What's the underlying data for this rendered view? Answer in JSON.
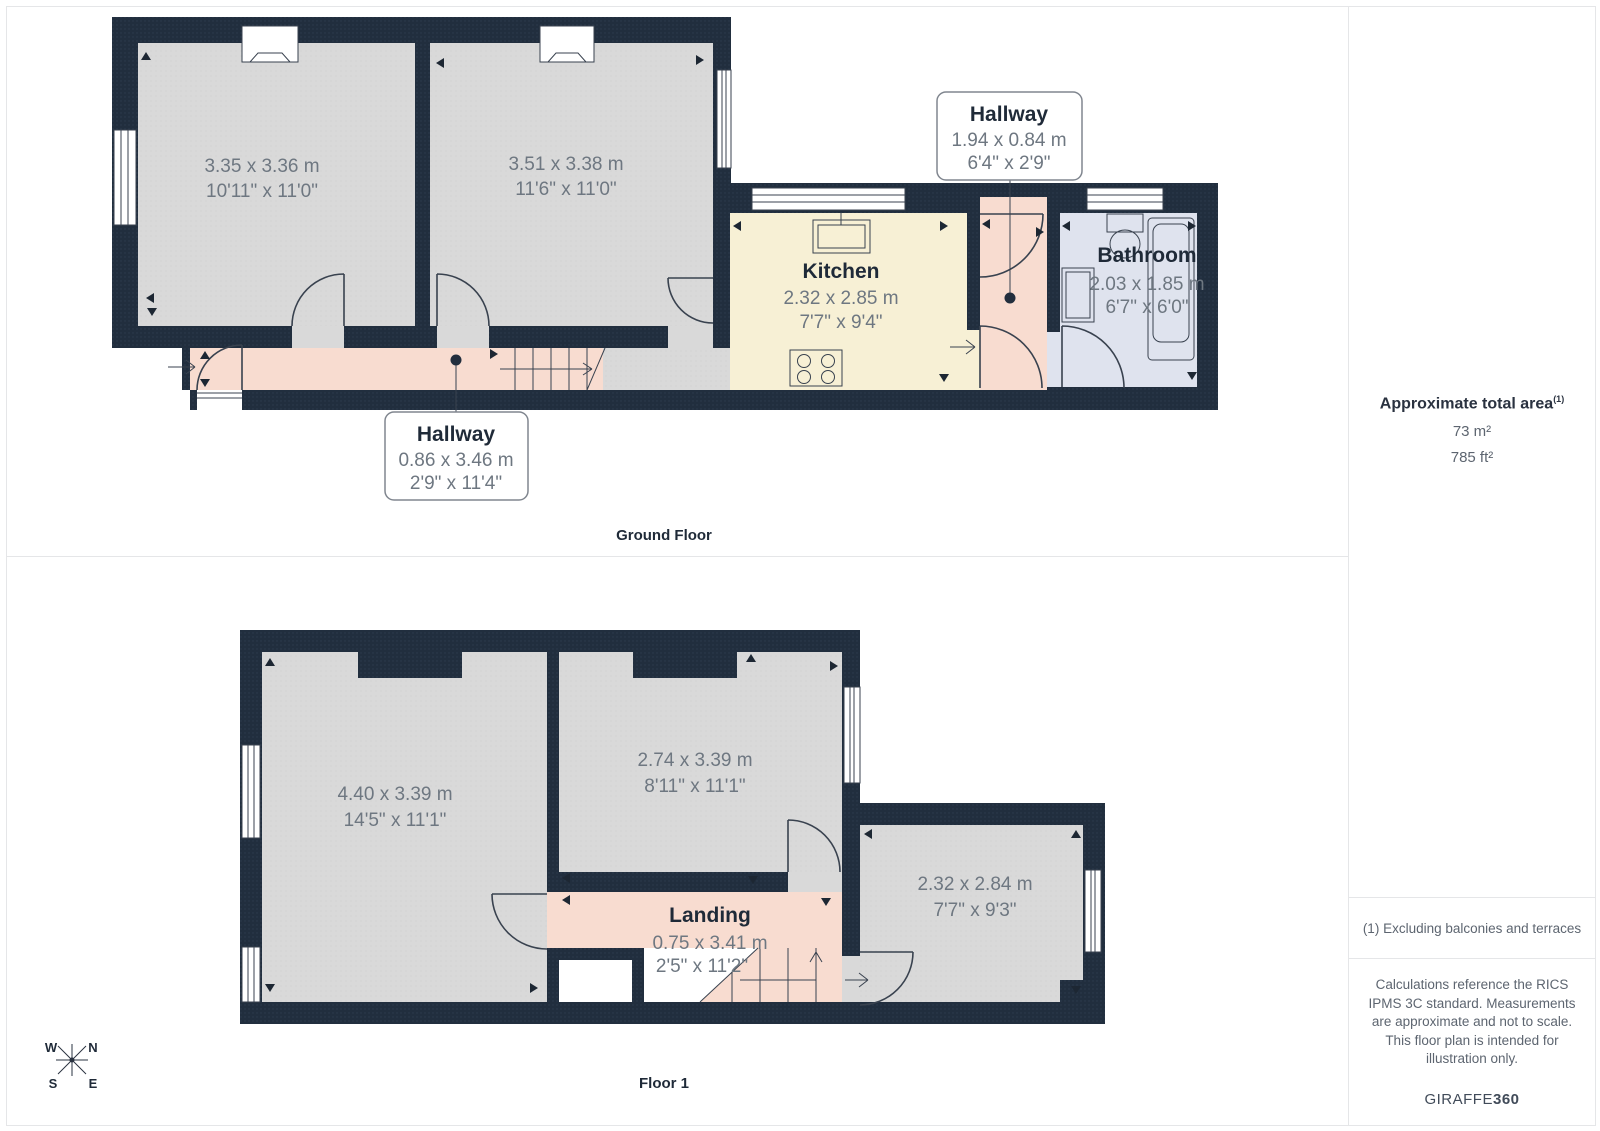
{
  "colors": {
    "wall": "#212e3e",
    "room_fill": "#d9d9d9",
    "hallway_fill": "#f8dcd0",
    "kitchen_fill": "#f7f0d5",
    "bathroom_fill": "#dfe3ee",
    "outline": "#39424f",
    "text_dark": "#1f2a38",
    "text_dim": "#6e7781",
    "panel_border": "#e5e6e8"
  },
  "ground_floor": {
    "caption": "Ground Floor",
    "room1": {
      "dim_m": "3.35 x 3.36 m",
      "dim_ft": "10'11\" x 11'0\""
    },
    "room2": {
      "dim_m": "3.51 x 3.38 m",
      "dim_ft": "11'6\" x 11'0\""
    },
    "kitchen": {
      "name": "Kitchen",
      "dim_m": "2.32 x 2.85 m",
      "dim_ft": "7'7\" x 9'4\""
    },
    "bathroom": {
      "name": "Bathroom",
      "dim_m": "2.03 x 1.85 m",
      "dim_ft": "6'7\" x 6'0\""
    },
    "hallway_upper": {
      "name": "Hallway",
      "dim_m": "1.94 x 0.84 m",
      "dim_ft": "6'4\" x 2'9\""
    },
    "hallway_lower": {
      "name": "Hallway",
      "dim_m": "0.86 x 3.46 m",
      "dim_ft": "2'9\" x 11'4\""
    }
  },
  "floor1": {
    "caption": "Floor 1",
    "bedroom1": {
      "dim_m": "4.40 x 3.39 m",
      "dim_ft": "14'5\" x 11'1\""
    },
    "bedroom2": {
      "dim_m": "2.74 x 3.39 m",
      "dim_ft": "8'11\" x 11'1\""
    },
    "bedroom3": {
      "dim_m": "2.32 x 2.84 m",
      "dim_ft": "7'7\" x 9'3\""
    },
    "landing": {
      "name": "Landing",
      "dim_m": "0.75 x 3.41 m",
      "dim_ft": "2'5\" x 11'2\""
    },
    "compass": {
      "w": "W",
      "n": "N",
      "s": "S",
      "e": "E"
    }
  },
  "sidebar": {
    "total_area_label": "Approximate total area",
    "footnote_marker": "(1)",
    "area_m2": "73 m²",
    "area_ft2": "785 ft²",
    "footnote": "(1) Excluding balconies and terraces",
    "disclaimer": "Calculations reference the RICS IPMS 3C standard. Measurements are approximate and not to scale. This floor plan is intended for illustration only.",
    "brand_regular": "GIRAFFE",
    "brand_bold": "360"
  }
}
